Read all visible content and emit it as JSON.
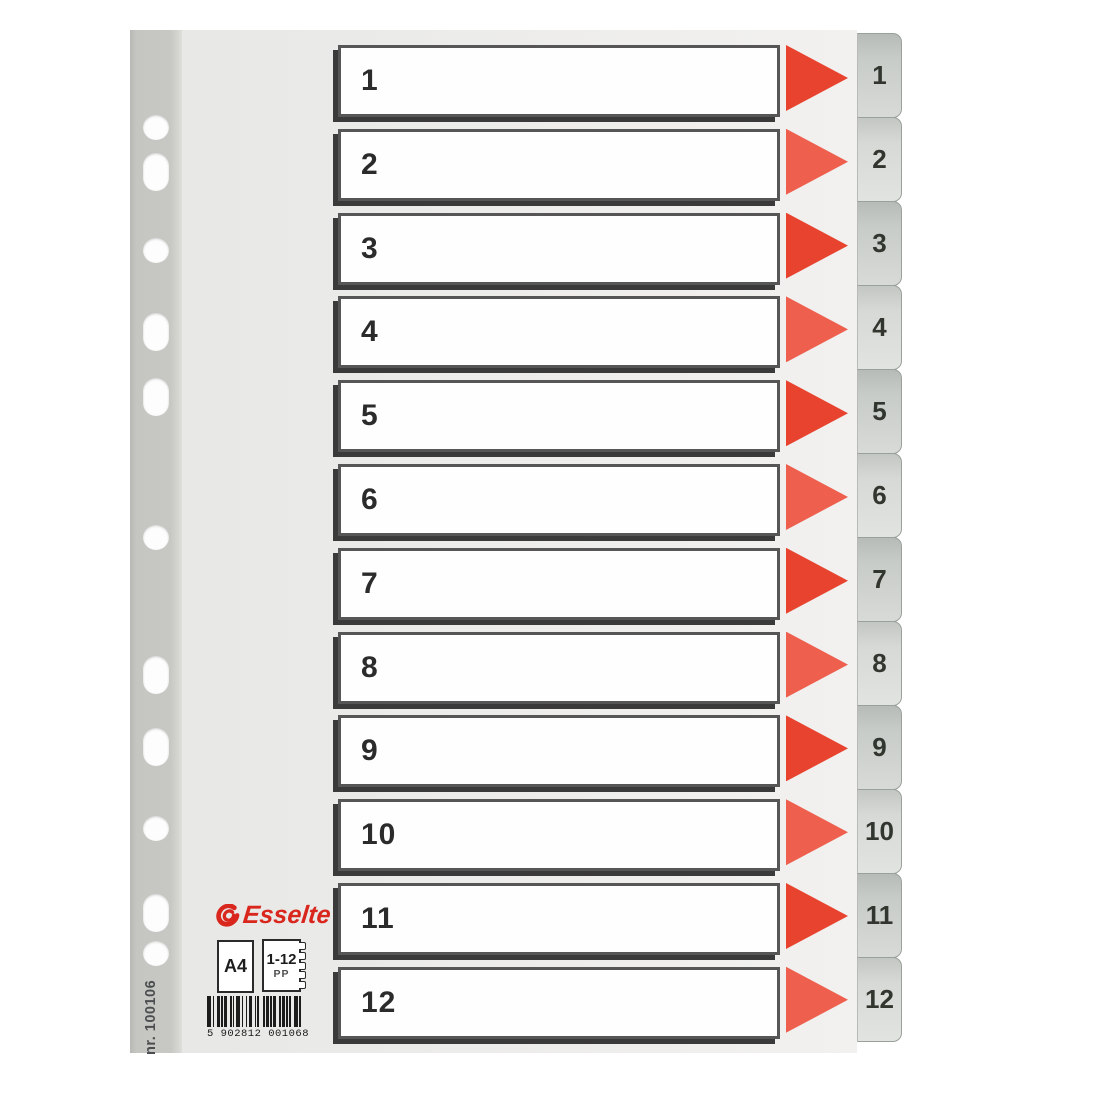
{
  "product": {
    "brand": "Esselte",
    "format": "A4",
    "tab_range": "1-12",
    "material": "PP",
    "item_number": "nr. 100106",
    "barcode": "5 902812 001068"
  },
  "rows": [
    {
      "number": "1"
    },
    {
      "number": "2"
    },
    {
      "number": "3"
    },
    {
      "number": "4"
    },
    {
      "number": "5"
    },
    {
      "number": "6"
    },
    {
      "number": "7"
    },
    {
      "number": "8"
    },
    {
      "number": "9"
    },
    {
      "number": "10"
    },
    {
      "number": "11"
    },
    {
      "number": "12"
    }
  ],
  "colors": {
    "brand_red": "#d9271e",
    "arrow_red_strong": "#e8432f",
    "arrow_red_soft": "#ee5f4e",
    "tab_grey_dark": "#c8ccc8",
    "tab_grey_light": "#d6d9d5",
    "spine_grey": "#c6c7c3",
    "sheet_grey": "#ececea",
    "number_ink": "#2b2b2b"
  }
}
